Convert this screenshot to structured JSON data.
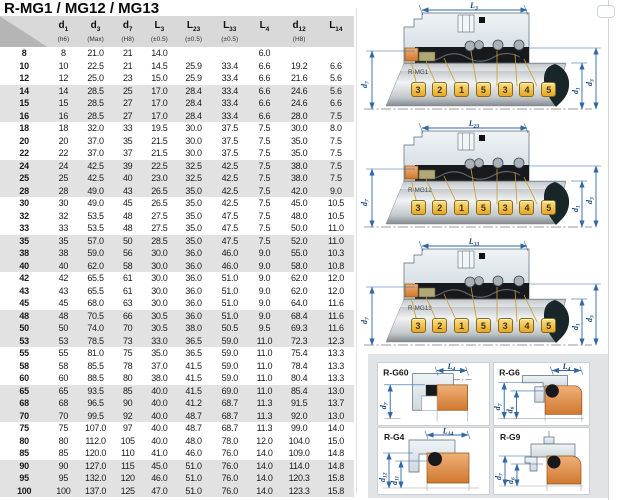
{
  "page": {
    "title": "R-MG1 / MG12 / MG13"
  },
  "colors": {
    "accent_blue": "#2f67a7",
    "seat_orange": "#e08f4e",
    "callout_yellow": "#f2c63f",
    "housing_gray": "#dfe6ea",
    "header_gray": "#d9d9d9",
    "shaded_row": "#e2e2e2"
  },
  "table": {
    "cols": [
      {
        "base": "d",
        "sub": "1",
        "note": "(h6)"
      },
      {
        "base": "d",
        "sub": "3",
        "note": "(Max)"
      },
      {
        "base": "d",
        "sub": "7",
        "note": "(H8)"
      },
      {
        "base": "L",
        "sub": "3",
        "note": "(±0.5)"
      },
      {
        "base": "L",
        "sub": "23",
        "note": "(±0.5)"
      },
      {
        "base": "L",
        "sub": "33",
        "note": "(±0.5)"
      },
      {
        "base": "L",
        "sub": "4",
        "note": ""
      },
      {
        "base": "d",
        "sub": "12",
        "note": "(H8)"
      },
      {
        "base": "L",
        "sub": "14",
        "note": ""
      }
    ],
    "rows": [
      [
        "8",
        "8",
        "21.0",
        "21",
        "14.0",
        "",
        "",
        "6.0",
        "",
        ""
      ],
      [
        "10",
        "10",
        "22.5",
        "21",
        "14.5",
        "25.9",
        "33.4",
        "6.6",
        "19.2",
        "6.6"
      ],
      [
        "12",
        "12",
        "25.0",
        "23",
        "15.0",
        "25.9",
        "33.4",
        "6.6",
        "21.6",
        "5.6"
      ],
      [
        "14",
        "14",
        "28.5",
        "25",
        "17.0",
        "28.4",
        "33.4",
        "6.6",
        "24.6",
        "5.6"
      ],
      [
        "15",
        "15",
        "28.5",
        "27",
        "17.0",
        "28.4",
        "33.4",
        "6.6",
        "24.6",
        "6.6"
      ],
      [
        "16",
        "16",
        "28.5",
        "27",
        "17.0",
        "28.4",
        "33.4",
        "6.6",
        "28.0",
        "7.5"
      ],
      [
        "18",
        "18",
        "32.0",
        "33",
        "19.5",
        "30.0",
        "37.5",
        "7.5",
        "30.0",
        "8.0"
      ],
      [
        "20",
        "20",
        "37.0",
        "35",
        "21.5",
        "30.0",
        "37.5",
        "7.5",
        "35.0",
        "7.5"
      ],
      [
        "22",
        "22",
        "37.0",
        "37",
        "21.5",
        "30.0",
        "37.5",
        "7.5",
        "35.0",
        "7.5"
      ],
      [
        "24",
        "24",
        "42.5",
        "39",
        "22.5",
        "32.5",
        "42.5",
        "7.5",
        "38.0",
        "7.5"
      ],
      [
        "25",
        "25",
        "42.5",
        "40",
        "23.0",
        "32.5",
        "42.5",
        "7.5",
        "38.0",
        "7.5"
      ],
      [
        "28",
        "28",
        "49.0",
        "43",
        "26.5",
        "35.0",
        "42.5",
        "7.5",
        "42.0",
        "9.0"
      ],
      [
        "30",
        "30",
        "49.0",
        "45",
        "26.5",
        "35.0",
        "42.5",
        "7.5",
        "45.0",
        "10.5"
      ],
      [
        "32",
        "32",
        "53.5",
        "48",
        "27.5",
        "35.0",
        "47.5",
        "7.5",
        "48.0",
        "10.5"
      ],
      [
        "33",
        "33",
        "53.5",
        "48",
        "27.5",
        "35.0",
        "47.5",
        "7.5",
        "50.0",
        "11.0"
      ],
      [
        "35",
        "35",
        "57.0",
        "50",
        "28.5",
        "35.0",
        "47.5",
        "7.5",
        "52.0",
        "11.0"
      ],
      [
        "38",
        "38",
        "59.0",
        "56",
        "30.0",
        "36.0",
        "46.0",
        "9.0",
        "55.0",
        "10.3"
      ],
      [
        "40",
        "40",
        "62.0",
        "58",
        "30.0",
        "36.0",
        "46.0",
        "9.0",
        "58.0",
        "10.8"
      ],
      [
        "42",
        "42",
        "65.5",
        "61",
        "30.0",
        "36.0",
        "51.0",
        "9.0",
        "62.0",
        "12.0"
      ],
      [
        "43",
        "43",
        "65.5",
        "61",
        "30.0",
        "36.0",
        "51.0",
        "9.0",
        "62.0",
        "12.0"
      ],
      [
        "45",
        "45",
        "68.0",
        "63",
        "30.0",
        "36.0",
        "51.0",
        "9.0",
        "64.0",
        "11.6"
      ],
      [
        "48",
        "48",
        "70.5",
        "66",
        "30.5",
        "36.0",
        "51.0",
        "9.0",
        "68.4",
        "11.6"
      ],
      [
        "50",
        "50",
        "74.0",
        "70",
        "30.5",
        "38.0",
        "50.5",
        "9.5",
        "69.3",
        "11.6"
      ],
      [
        "53",
        "53",
        "78.5",
        "73",
        "33.0",
        "36.5",
        "59.0",
        "11.0",
        "72.3",
        "12.3"
      ],
      [
        "55",
        "55",
        "81.0",
        "75",
        "35.0",
        "36.5",
        "59.0",
        "11.0",
        "75.4",
        "13.3"
      ],
      [
        "58",
        "58",
        "85.5",
        "78",
        "37.0",
        "41.5",
        "59.0",
        "11.0",
        "78.4",
        "13.3"
      ],
      [
        "60",
        "60",
        "88.5",
        "80",
        "38.0",
        "41.5",
        "59.0",
        "11.0",
        "80.4",
        "13.3"
      ],
      [
        "65",
        "65",
        "93.5",
        "85",
        "40.0",
        "41.5",
        "69.0",
        "11.0",
        "85.4",
        "13.0"
      ],
      [
        "68",
        "68",
        "96.5",
        "90",
        "40.0",
        "41.2",
        "68.7",
        "11.3",
        "91.5",
        "13.7"
      ],
      [
        "70",
        "70",
        "99.5",
        "92",
        "40.0",
        "48.7",
        "68.7",
        "11.3",
        "92.0",
        "13.0"
      ],
      [
        "75",
        "75",
        "107.0",
        "97",
        "40.0",
        "48.7",
        "68.7",
        "11.3",
        "99.0",
        "14.0"
      ],
      [
        "80",
        "80",
        "112.0",
        "105",
        "40.0",
        "48.0",
        "78.0",
        "12.0",
        "104.0",
        "15.0"
      ],
      [
        "85",
        "85",
        "120.0",
        "110",
        "41.0",
        "46.0",
        "76.0",
        "14.0",
        "109.0",
        "14.8"
      ],
      [
        "90",
        "90",
        "127.0",
        "115",
        "45.0",
        "51.0",
        "76.0",
        "14.0",
        "114.0",
        "14.8"
      ],
      [
        "95",
        "95",
        "132.0",
        "120",
        "46.0",
        "51.0",
        "76.0",
        "14.0",
        "120.3",
        "15.8"
      ],
      [
        "100",
        "100",
        "137.0",
        "125",
        "47.0",
        "51.0",
        "76.0",
        "14.0",
        "123.3",
        "15.8"
      ]
    ]
  },
  "diagrams": [
    {
      "name": "R-MG1",
      "top_dim": {
        "base": "L",
        "sub": "3"
      },
      "left_dim": {
        "base": "d",
        "sub": "7"
      },
      "right_dims": [
        {
          "base": "d",
          "sub": "1"
        },
        {
          "base": "d",
          "sub": "3"
        }
      ],
      "callouts": [
        "3",
        "2",
        "1",
        "5",
        "3",
        "4",
        "5"
      ]
    },
    {
      "name": "R-MG12",
      "top_dim": {
        "base": "L",
        "sub": "23"
      },
      "left_dim": {
        "base": "d",
        "sub": "7"
      },
      "right_dims": [
        {
          "base": "d",
          "sub": "1"
        },
        {
          "base": "d",
          "sub": "3"
        }
      ],
      "callouts": [
        "3",
        "2",
        "1",
        "5",
        "3",
        "4",
        "5"
      ]
    },
    {
      "name": "R-MG13",
      "top_dim": {
        "base": "L",
        "sub": "33"
      },
      "left_dim": {
        "base": "d",
        "sub": "7"
      },
      "right_dims": [
        {
          "base": "d",
          "sub": "1"
        },
        {
          "base": "d",
          "sub": "3"
        }
      ],
      "callouts": [
        "3",
        "2",
        "1",
        "5",
        "3",
        "4",
        "5"
      ]
    }
  ],
  "seats": [
    {
      "name": "R-G60",
      "top_dim": {
        "base": "L",
        "sub": "4"
      },
      "left_dims": [
        {
          "base": "d",
          "sub": "7"
        }
      ]
    },
    {
      "name": "R-G6",
      "top_dim": {
        "base": "L",
        "sub": "4"
      },
      "left_dims": [
        {
          "base": "d",
          "sub": "7"
        },
        {
          "base": "d",
          "sub": "6"
        }
      ]
    },
    {
      "name": "R-G4",
      "top_dim": {
        "base": "L",
        "sub": "14"
      },
      "left_dims": [
        {
          "base": "d",
          "sub": "12"
        },
        {
          "base": "d",
          "sub": "11"
        }
      ]
    },
    {
      "name": "R-G9",
      "top_dim": null,
      "left_dims": [
        {
          "base": "d",
          "sub": "7"
        },
        {
          "base": "d",
          "sub": "6"
        }
      ]
    }
  ]
}
